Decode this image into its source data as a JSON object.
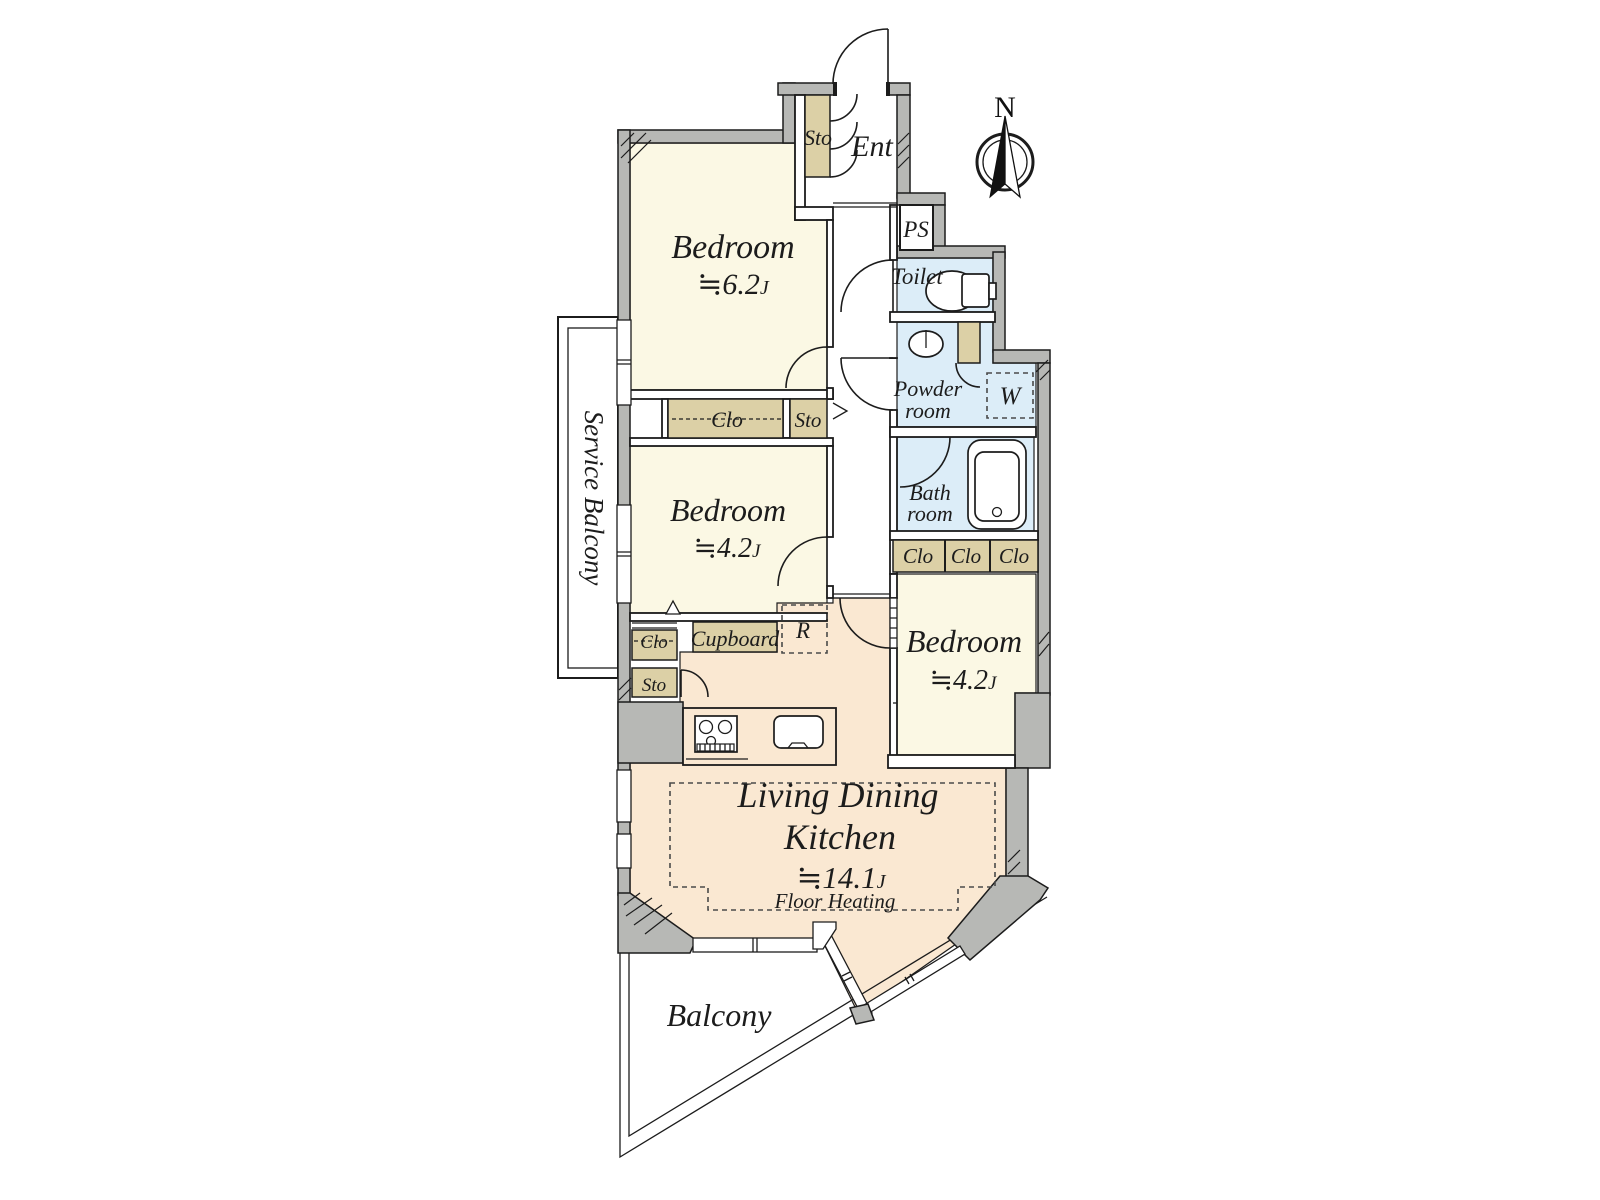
{
  "compass": {
    "north": "N"
  },
  "rooms": {
    "bedroom_top": {
      "name": "Bedroom",
      "area": "≒6.2",
      "unit": "J"
    },
    "bedroom_mid": {
      "name": "Bedroom",
      "area": "≒4.2",
      "unit": "J"
    },
    "bedroom_right": {
      "name": "Bedroom",
      "area": "≒4.2",
      "unit": "J"
    },
    "ldk": {
      "line1": "Living Dining",
      "line2": "Kitchen",
      "area": "≒14.1",
      "unit": "J",
      "note": "Floor Heating"
    },
    "entrance": {
      "label": "Ent"
    },
    "ps": {
      "label": "PS"
    },
    "toilet": {
      "label": "Toilet"
    },
    "powder": {
      "line1": "Powder",
      "line2": "room"
    },
    "bath": {
      "line1": "Bath",
      "line2": "room"
    },
    "balcony": {
      "label": "Balcony"
    },
    "service_balcony": {
      "label": "Service Balcony"
    }
  },
  "storage": {
    "entrance_sto": "Sto",
    "hall_clo": "Clo",
    "hall_sto": "Sto",
    "bedroom_clo": "Clo",
    "kitchen_sto": "Sto",
    "cupboard": "Cupboard",
    "refrigerator": "R",
    "washer": "W",
    "clo_row": [
      "Clo",
      "Clo",
      "Clo"
    ]
  },
  "colors": {
    "wall_gray": "#b7b8b5",
    "room_cream": "#fbf8e4",
    "ldk_peach": "#fae8d2",
    "closet_tan": "#dcd0a6",
    "wet_area_blue": "#dcedf8",
    "line": "#1c1c1c"
  }
}
